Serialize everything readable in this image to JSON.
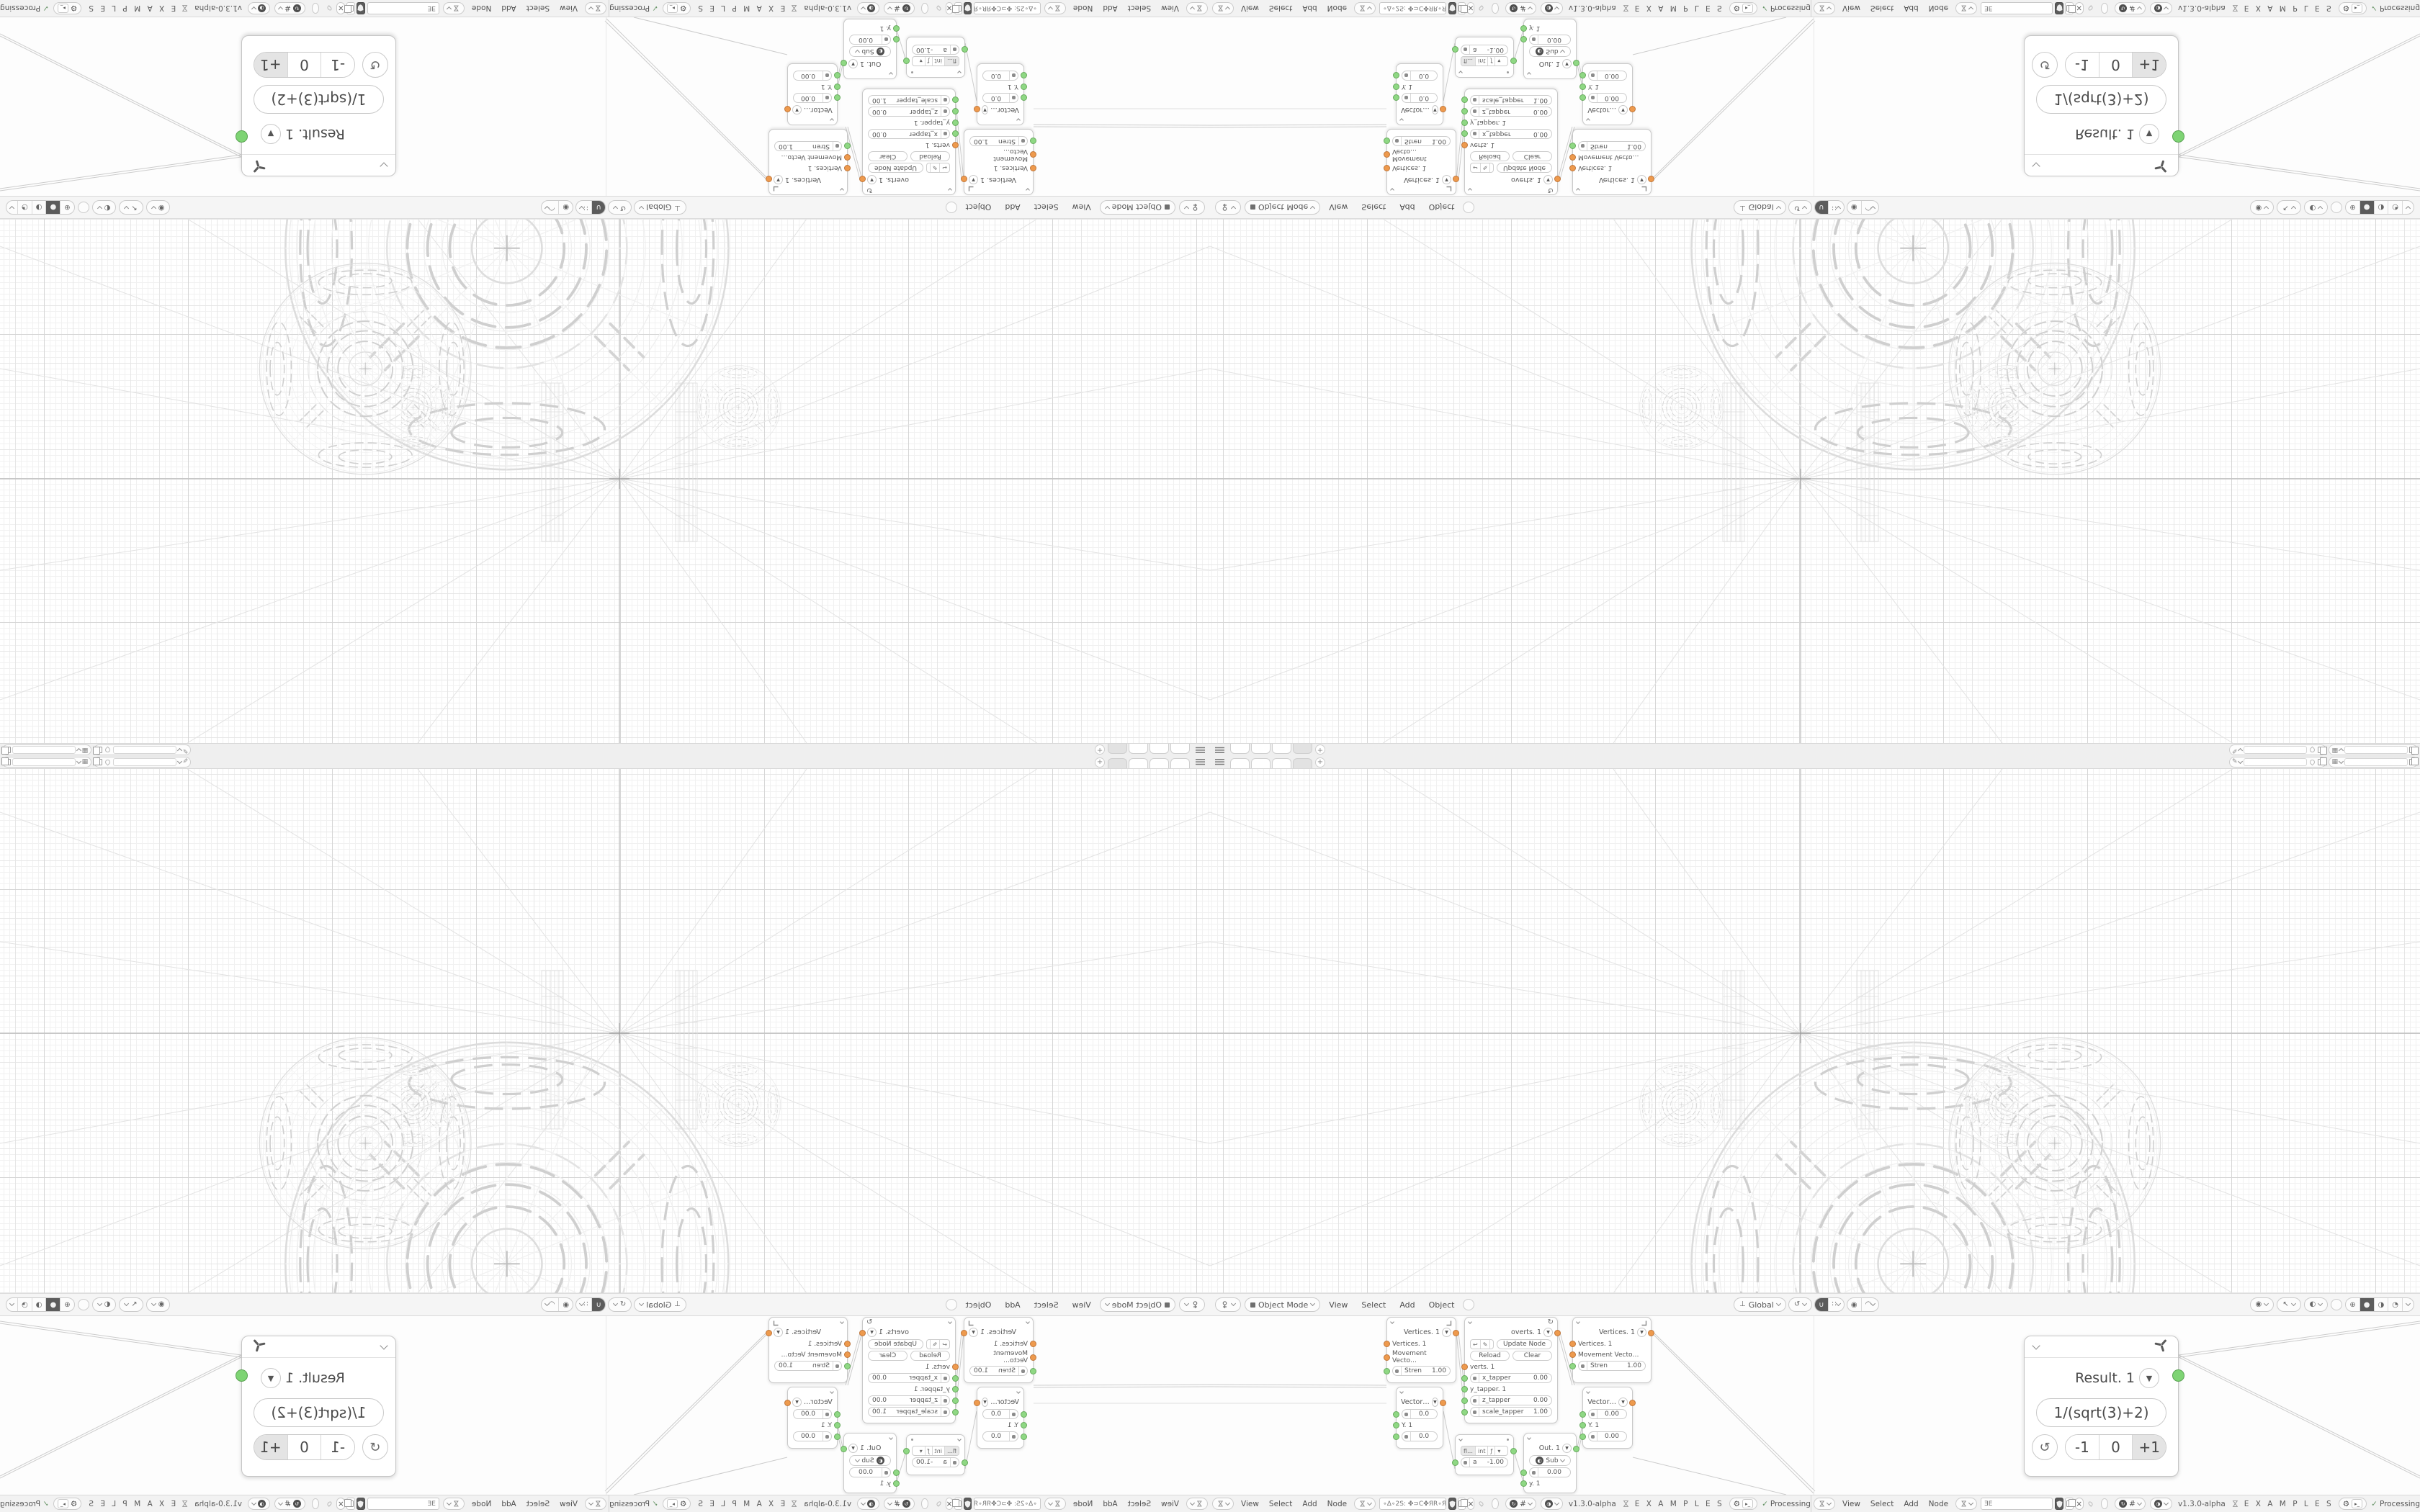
{
  "accent_colors": {
    "socket_orange": "#ee9a4d",
    "socket_green": "#8fd884",
    "result_green": "#7ed474",
    "ui_dark": "#5c5c5c"
  },
  "tabbar": {
    "add_label": "+"
  },
  "viewport_header": {
    "mode_label": "Object Mode",
    "menus": [
      "View",
      "Select",
      "Add",
      "Object"
    ],
    "orientation": "Global"
  },
  "node_header": {
    "menus": [
      "View",
      "Select",
      "Add",
      "Node"
    ],
    "tree_a": "∘Δ∘2S: ✤⊃C✤ЯR∘ЯR✤⊃C✤ :2S∘Δ∘",
    "tree_b": "ƎE",
    "version": "v1.3.0-alpha",
    "brand": "E X A M P L E S",
    "status_check": "✓",
    "status": "Processing"
  },
  "nodes": {
    "vertices": {
      "title": "Vertices. 1",
      "out": "Vertices. 1",
      "in1": "Vertices. 1",
      "in2": "Movement Vecto…",
      "stren_label": "Stren",
      "stren_value": "1.00"
    },
    "overts": {
      "title": "overts. 1",
      "update": "Update Node",
      "reload": "Reload",
      "clear": "Clear",
      "verts": "verts. 1",
      "x_label": "x_tapper",
      "x_value": "0.00",
      "y_label": "y_tapper. 1",
      "z_label": "z_tapper",
      "z_value": "0.00",
      "scale_label": "scale_tapper",
      "scale_value": "1.00"
    },
    "vector_a": {
      "title": "Vector…",
      "v1": "0.0",
      "mid": "Y. 1",
      "v2": "0.0"
    },
    "vector_b": {
      "title": "Vector…",
      "v1": "0.00",
      "mid": "Y. 1",
      "v2": "0.00"
    },
    "number": {
      "seg_fl": "fl…",
      "seg_int": "int",
      "seg_fn": "ƒ",
      "seg_dd": "▾",
      "a_label": "a",
      "a_value": "-1.00"
    },
    "out": {
      "title": "Out. 1",
      "op": "Sub",
      "v1": "0.00",
      "y": "y. 1"
    }
  },
  "result_panel": {
    "title": "Result. 1",
    "expression": "1/(sqrt(3)+2)",
    "minus": "-1",
    "zero": "0",
    "plus": "+1"
  },
  "icons": {
    "dropdown": "▼",
    "sync": "↻",
    "undo": "↩",
    "edit": "✎",
    "refresh": "↺",
    "close": "×",
    "grid": "#",
    "tree": "⋈",
    "brand_tie": "⋈",
    "orientation_axis": "⊥",
    "snap_magnet": "∪",
    "snap_grid": "∷",
    "prop_circle": "◉",
    "prop_curve": "◠",
    "overlays_eye": "◉",
    "gizmo_arrow": "↖",
    "overlay_half": "◐",
    "shade_globe": "⊕",
    "shade_solid": "●",
    "shade_material": "◑",
    "shade_render": "◔",
    "sub_disc": "◐",
    "gear": "⚙",
    "terminal": "▸_",
    "brush": "✎",
    "image": "▦"
  }
}
